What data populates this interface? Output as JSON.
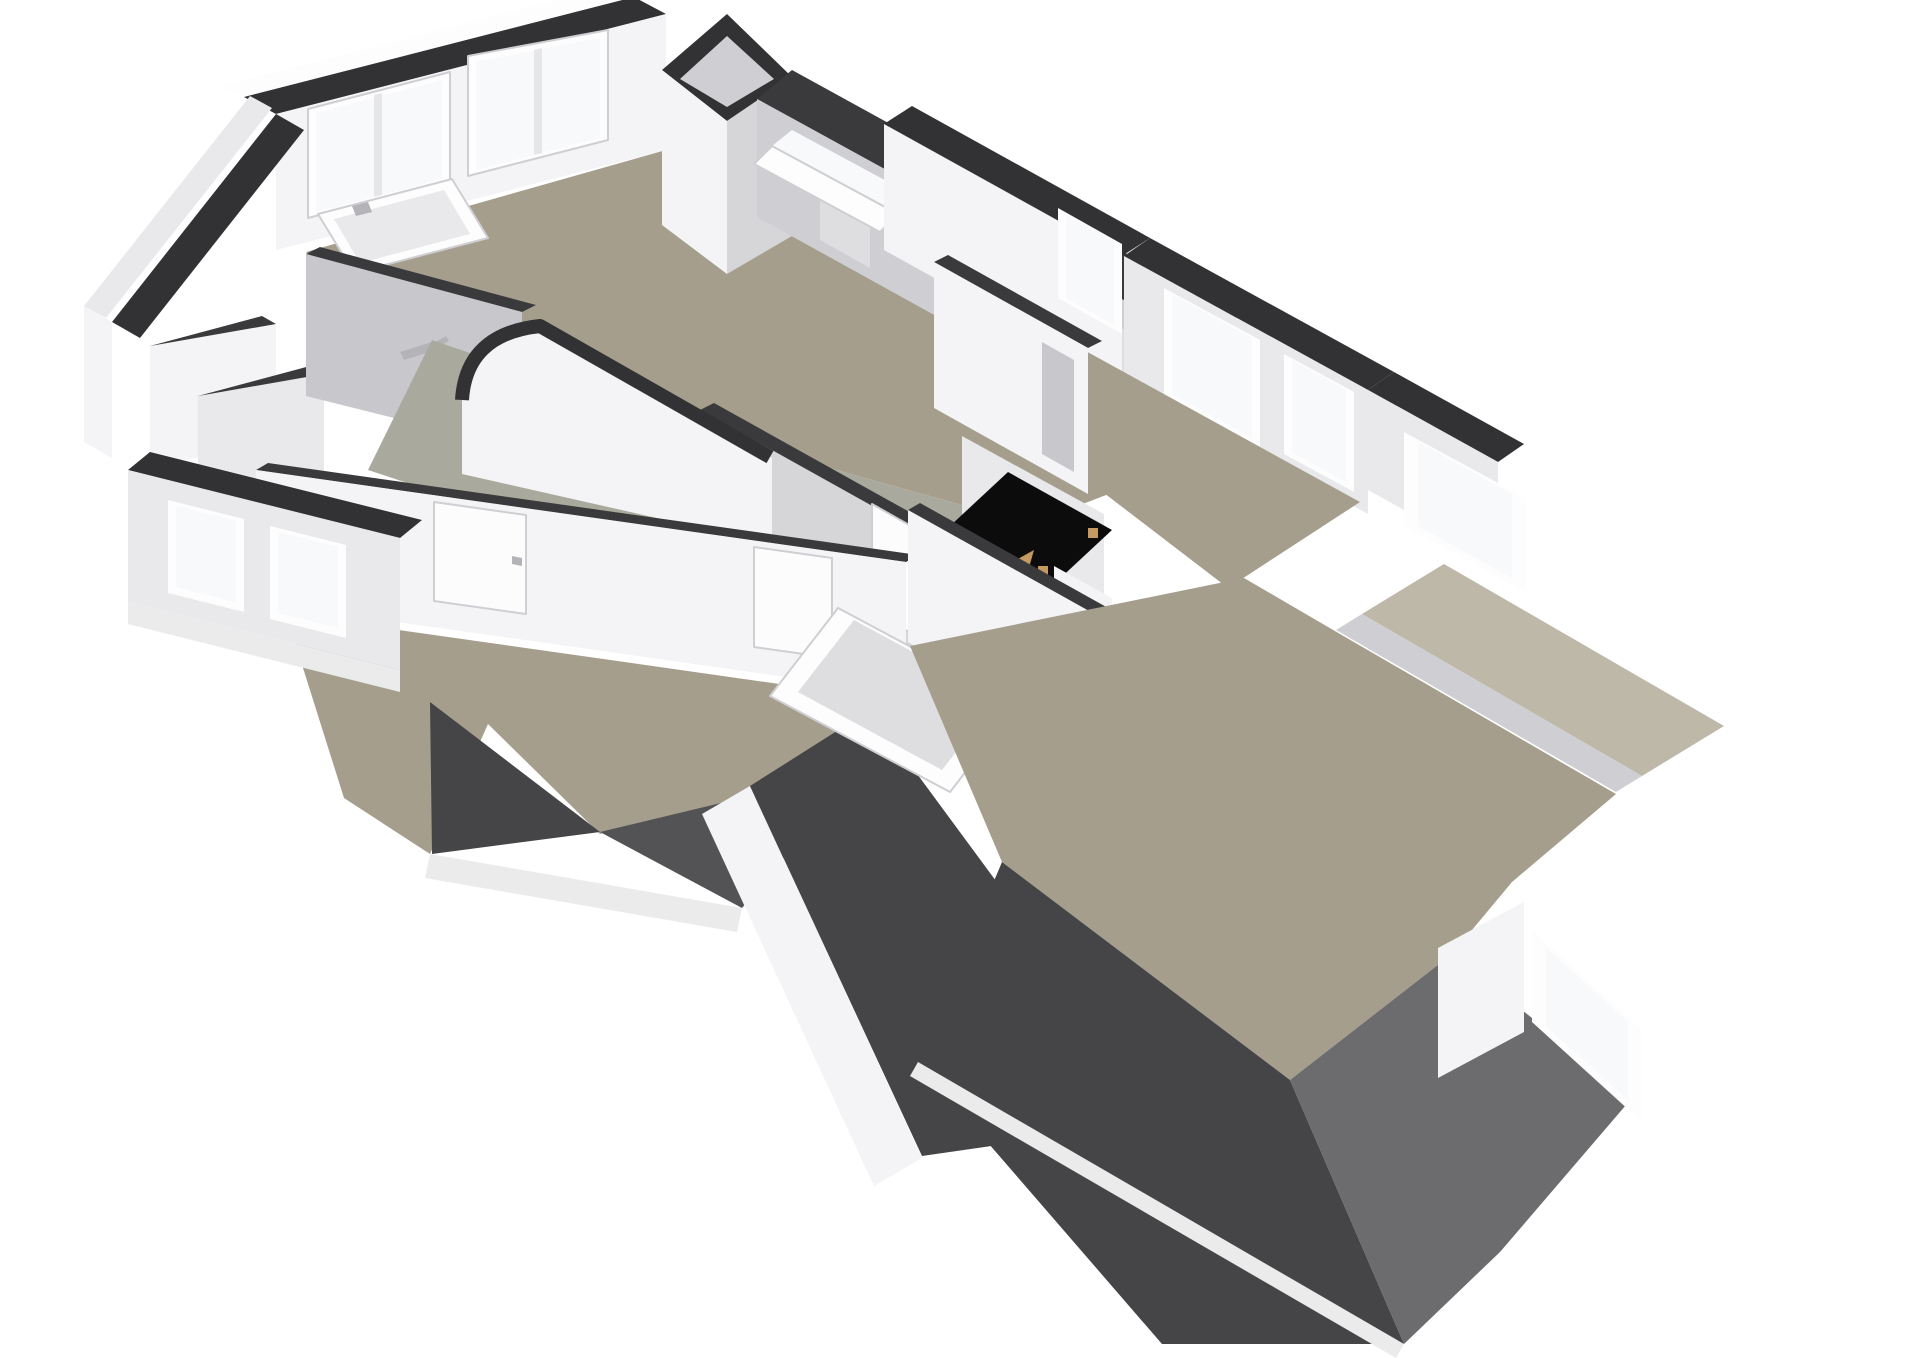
{
  "palette": {
    "cap": "#323234",
    "cap2": "#3a3a3c",
    "white": "#fdfdfd",
    "wall1": "#f4f4f6",
    "wall2": "#e9e9ec",
    "wall3": "#d6d6d9",
    "wall4": "#c8c8cc",
    "knee": "#cfcfd3",
    "panel": "#dedee1",
    "glass": "#f7f9fa",
    "floorA": "#a59e8d",
    "floorB": "#a9aa9d",
    "flatRoof": "#bdb8a7",
    "roof1": "#454547",
    "roof2": "#535355",
    "roof3": "#6c6c6e",
    "fascia": "#ebebec",
    "void": "#0c0c0c",
    "wood": "#c49a62",
    "metal": "#b4b4b8",
    "door": "#fcfcfd",
    "doorline": "#cfcfd3",
    "mullion": "#e6e6e9"
  },
  "scene": {
    "shapes": [
      {
        "name": "nw-outer-edge",
        "fill": "white",
        "points": "222,86 612,-14 634,-3 244,97"
      },
      {
        "name": "nw-wall-cap",
        "fill": "cap",
        "points": "244,97 634,-3 666,14 276,114"
      },
      {
        "name": "nw-wall-face",
        "fill": "wall1",
        "points": "276,114 666,14 666,150 276,250"
      },
      {
        "name": "bath-window-1-frame",
        "fill": "white",
        "stroke": "doorline",
        "sw": 2,
        "points": "308,218 450,181 450,72 308,109"
      },
      {
        "name": "bath-window-1-glass",
        "fill": "glass",
        "points": "316,212 442,179 442,80 316,113"
      },
      {
        "name": "bath-window-1-mullion",
        "fill": "mullion",
        "points": "374,197 382,195 382,93 374,95"
      },
      {
        "name": "bath-window-2-frame",
        "fill": "white",
        "stroke": "doorline",
        "sw": 2,
        "points": "468,176 608,140 608,30 468,56"
      },
      {
        "name": "bath-window-2-glass",
        "fill": "glass",
        "points": "476,170 600,138 600,38 476,62"
      },
      {
        "name": "bath-window-2-mullion",
        "fill": "mullion",
        "points": "534,155 542,153 542,48 534,50"
      },
      {
        "name": "west-gable-outer",
        "fill": "wall2",
        "points": "84,306 250,96 272,108 106,318"
      },
      {
        "name": "west-gable-cap",
        "fill": "cap",
        "points": "112,322 276,114 304,130 140,338"
      },
      {
        "name": "west-outer-face",
        "fill": "wall1",
        "points": "84,306 84,442 112,458 112,322"
      },
      {
        "name": "closet-wall-a-cap",
        "fill": "cap2",
        "points": "150,346 262,316 276,324 164,354"
      },
      {
        "name": "closet-wall-a",
        "fill": "wall1",
        "points": "150,346 276,324 276,444 150,466"
      },
      {
        "name": "closet-wall-b-cap",
        "fill": "cap2",
        "points": "198,396 310,366 324,374 212,404"
      },
      {
        "name": "closet-wall-b",
        "fill": "wall2",
        "points": "198,396 324,374 324,494 198,516"
      },
      {
        "name": "top-room-floor",
        "fill": "floorA",
        "points": "306,252 666,150 757,215 1198,460 1030,524 700,432 432,340"
      },
      {
        "name": "bathtub-outer",
        "fill": "white",
        "stroke": "doorline",
        "sw": 2,
        "points": "318,214 452,179 488,238 354,273"
      },
      {
        "name": "bathtub-inner",
        "fill": "wall2",
        "points": "334,219 444,190 470,234 360,263"
      },
      {
        "name": "bathtub-faucet",
        "fill": "metal",
        "points": "352,206 368,202 372,212 356,216"
      },
      {
        "name": "shower-wall-cap",
        "fill": "cap2",
        "points": "306,254 522,312 536,305 320,247"
      },
      {
        "name": "shower-wall",
        "fill": "wall4",
        "points": "306,254 522,312 522,450 306,396"
      },
      {
        "name": "shower-head",
        "fill": "metal",
        "points": "400,352 432,342 436,350 404,360"
      },
      {
        "name": "shower-hose",
        "fill": "metal",
        "points": "428,346 446,336 449,341 431,351"
      },
      {
        "name": "chimney-cap",
        "fill": "cap",
        "points": "727,14 792,77 727,121 662,70"
      },
      {
        "name": "chimney-shaft-inner",
        "fill": "knee",
        "points": "727,36 774,79 727,107 680,79"
      },
      {
        "name": "chimney-left-face",
        "fill": "wall1",
        "points": "662,70 727,121 727,274 662,225"
      },
      {
        "name": "chimney-right-face",
        "fill": "wall3",
        "points": "727,121 792,77 792,236 727,274"
      },
      {
        "name": "ne-roof-band",
        "fill": "cap2",
        "points": "792,70 1240,316 1200,342 757,99"
      },
      {
        "name": "ne-knee-wall",
        "fill": "knee",
        "points": "757,99 1200,342 1200,462 757,217"
      },
      {
        "name": "knee-panel-1",
        "fill": "panel",
        "points": "820,160 870,188 870,268 820,240"
      },
      {
        "name": "knee-panel-2",
        "fill": "panel",
        "points": "950,232 1000,260 1000,340 950,312"
      },
      {
        "name": "knee-panel-3",
        "fill": "panel",
        "points": "1080,305 1130,333 1130,413 1080,385"
      },
      {
        "name": "skylight-open-pane",
        "fill": "glass",
        "points": "772,146 898,214 918,198 792,130"
      },
      {
        "name": "skylight-frame",
        "fill": "white",
        "stroke": "doorline",
        "sw": 2,
        "points": "772,146 898,214 880,232 754,164"
      },
      {
        "name": "hall-floor",
        "fill": "floorB",
        "points": "432,340 700,432 1030,524 1088,560 948,680 640,560 368,470"
      },
      {
        "name": "bedroom1-nw-cap",
        "fill": "cap",
        "points": "912,106 1150,238 1122,256 884,124"
      },
      {
        "name": "bedroom1-nw-face",
        "fill": "wall1",
        "points": "884,124 1122,256 1122,382 884,250"
      },
      {
        "name": "bedroom1-window-0-frame",
        "fill": "white",
        "points": "1058,208 1122,244 1122,334 1058,298"
      },
      {
        "name": "bedroom1-window-0-glass",
        "fill": "glass",
        "points": "1066,214 1114,241 1114,325 1066,298"
      },
      {
        "name": "bedroom1-ne-cap",
        "fill": "cap",
        "points": "1150,238 1394,372 1368,390 1124,256"
      },
      {
        "name": "bedroom1-ne-face",
        "fill": "wall2",
        "points": "1124,256 1368,390 1368,514 1124,380"
      },
      {
        "name": "bedroom1-window-1-frame",
        "fill": "white",
        "points": "1164,288 1260,340 1260,448 1164,396"
      },
      {
        "name": "bedroom1-window-1-glass",
        "fill": "glass",
        "points": "1172,294 1252,338 1252,438 1172,394"
      },
      {
        "name": "bedroom1-window-2-frame",
        "fill": "white",
        "points": "1284,354 1354,392 1354,492 1284,454"
      },
      {
        "name": "bedroom1-window-2-glass",
        "fill": "glass",
        "points": "1292,360 1346,390 1346,482 1292,452"
      },
      {
        "name": "bedroom1-floor",
        "fill": "floorA",
        "points": "1004,306 1360,502 1228,588 946,372"
      },
      {
        "name": "far-gable-cap",
        "fill": "cap",
        "points": "1394,372 1524,444 1498,462 1368,390"
      },
      {
        "name": "far-gable-face",
        "fill": "wall2",
        "points": "1368,390 1498,462 1498,562 1368,490"
      },
      {
        "name": "recessed-window-frame",
        "fill": "white",
        "points": "1404,432 1526,498 1526,592 1404,526"
      },
      {
        "name": "recessed-window-glass",
        "fill": "glass",
        "points": "1418,442 1512,494 1512,578 1418,526"
      },
      {
        "name": "flat-roof-strip",
        "fill": "flatRoof",
        "points": "1444,564 1724,726 1642,776 1362,614"
      },
      {
        "name": "flat-roof-inner-band",
        "fill": "knee",
        "points": "1362,614 1642,776 1616,792 1336,630"
      },
      {
        "name": "landing-wall-cap",
        "fill": "cap2",
        "points": "700,410 962,556 976,549 714,403"
      },
      {
        "name": "landing-wall",
        "fill": "wall3",
        "points": "700,410 962,556 962,676 700,530"
      },
      {
        "name": "landing-door",
        "fill": "door",
        "stroke": "doorline",
        "sw": 2,
        "points": "872,504 934,539 934,646 872,611"
      },
      {
        "name": "landing-door-handle",
        "fill": "metal",
        "points": "922,600 930,604 930,612 922,608"
      },
      {
        "name": "stairwell-curved-wall",
        "fill": "wall1",
        "d": "M 462,474 L 462,400 Q 466,334 540,326 L 772,458 L 772,544 Z"
      },
      {
        "name": "stairwell-curved-cap",
        "stroke": "cap",
        "sw": 14,
        "fill": "none",
        "d": "M 462,400 Q 466,334 540,326 L 770,457"
      },
      {
        "name": "stair-back-wall",
        "fill": "wall2",
        "points": "962,436 1104,514 1104,646 962,568"
      },
      {
        "name": "stair-void",
        "fill": "void",
        "points": "1008,472 1112,530 1054,584 950,526"
      },
      {
        "name": "stair-hinge-1",
        "fill": "wood",
        "points": "1088,528 1098,528 1098,538 1088,538"
      },
      {
        "name": "stair-hinge-2",
        "fill": "wood",
        "points": "1038,566 1048,566 1048,576 1038,576"
      },
      {
        "name": "loft-ladder-rail",
        "fill": "wood",
        "points": "1016,560 1034,550 1006,648 988,658"
      },
      {
        "name": "stair-front-wall",
        "fill": "wall1",
        "points": "1054,566 1112,598 1112,712 1054,680"
      },
      {
        "name": "bedroom1-sw-cap",
        "fill": "cap2",
        "points": "934,262 1088,348 1102,341 948,255"
      },
      {
        "name": "bedroom1-sw-wall",
        "fill": "wall1",
        "points": "934,262 1088,348 1088,494 934,408"
      },
      {
        "name": "bedroom1-door-opening",
        "fill": "wall4",
        "points": "1042,342 1074,360 1074,472 1042,454"
      },
      {
        "name": "hall-sw-cap",
        "fill": "cap2",
        "points": "256,470 906,562 918,555 268,463"
      },
      {
        "name": "hall-sw-wall",
        "fill": "wall1",
        "points": "256,470 906,562 906,694 256,602"
      },
      {
        "name": "bedroom2-door",
        "fill": "door",
        "stroke": "doorline",
        "sw": 2,
        "points": "434,502 526,515 526,614 434,601"
      },
      {
        "name": "bedroom2-door-handle",
        "fill": "metal",
        "points": "512,556 522,558 522,566 512,564"
      },
      {
        "name": "hall-door-2",
        "fill": "door",
        "stroke": "doorline",
        "sw": 2,
        "points": "754,547 832,558 832,658 754,647"
      },
      {
        "name": "bedroom2-floor",
        "fill": "floorA",
        "points": "286,614 892,700 858,770 600,834 488,724 430,854 344,798"
      },
      {
        "name": "bedroom2-sw-cap",
        "fill": "cap",
        "points": "150,452 422,520 400,538 128,470"
      },
      {
        "name": "bedroom2-outer-face",
        "fill": "wall2",
        "points": "128,470 400,538 400,670 128,602"
      },
      {
        "name": "bedroom2-window-a-frame",
        "fill": "white",
        "points": "168,500 244,519 244,612 168,593"
      },
      {
        "name": "bedroom2-window-a-glass",
        "fill": "glass",
        "points": "176,506 236,521 236,602 176,587"
      },
      {
        "name": "bedroom2-window-b-frame",
        "fill": "white",
        "points": "270,526 346,545 346,638 270,619"
      },
      {
        "name": "bedroom2-window-b-glass",
        "fill": "glass",
        "points": "278,532 338,547 338,628 278,613"
      },
      {
        "name": "bedroom2-fascia",
        "fill": "fascia",
        "points": "128,602 400,670 400,692 128,624"
      },
      {
        "name": "roof-wedge-1",
        "fill": "roof1",
        "points": "430,702 600,832 432,854"
      },
      {
        "name": "roof-wedge-2",
        "fill": "roof2",
        "points": "600,832 858,770 742,908"
      },
      {
        "name": "roof-wedge-fascia",
        "fill": "fascia",
        "points": "430,854 742,908 737,932 425,878"
      },
      {
        "name": "center-parapet-wall",
        "fill": "wall1",
        "points": "702,814 750,786 922,1158 874,1186"
      },
      {
        "name": "center-roof-slope",
        "fill": "roof1",
        "points": "750,786 870,710 1172,1120 922,1156"
      },
      {
        "name": "tilted-panel-frame",
        "fill": "white",
        "stroke": "doorline",
        "sw": 2,
        "points": "838,608 1018,704 950,792 770,696"
      },
      {
        "name": "tilted-panel-glass",
        "fill": "panel",
        "points": "854,620 998,698 942,770 798,692"
      },
      {
        "name": "livingroom-nw-cap",
        "fill": "cap2",
        "points": "908,510 1252,702 1264,695 920,503"
      },
      {
        "name": "livingroom-nw-wall",
        "fill": "wall1",
        "points": "908,510 1252,702 1252,834 908,642"
      },
      {
        "name": "livingroom-door",
        "fill": "door",
        "stroke": "doorline",
        "sw": 2,
        "points": "1160,650 1224,686 1224,792 1160,756"
      },
      {
        "name": "livingroom-door-handle",
        "fill": "metal",
        "points": "1166,716 1176,722 1176,730 1166,724"
      },
      {
        "name": "livingroom-floor",
        "fill": "floorA",
        "points": "910,646 1244,578 1340,634 1616,794 1512,882 1452,954 1290,1080 1002,862"
      },
      {
        "name": "main-roof-left-slope",
        "fill": "roof1",
        "points": "1002,862 1290,1080 1404,1344 1162,1344 918,1062"
      },
      {
        "name": "main-roof-right-slope",
        "fill": "roof3",
        "points": "1290,1080 1452,954 1632,1098 1500,1252 1404,1344"
      },
      {
        "name": "main-roof-fascia",
        "fill": "fascia",
        "points": "918,1062 1404,1344 1396,1358 910,1076"
      },
      {
        "name": "dormer-side-wall",
        "fill": "wall1",
        "points": "1438,948 1524,902 1524,1032 1438,1078"
      },
      {
        "name": "dormer-window-frame",
        "fill": "white",
        "points": "1532,930 1642,1030 1642,1122 1532,1022"
      },
      {
        "name": "dormer-window-glass",
        "fill": "glass",
        "points": "1546,948 1628,1022 1628,1100 1546,1026"
      }
    ]
  }
}
